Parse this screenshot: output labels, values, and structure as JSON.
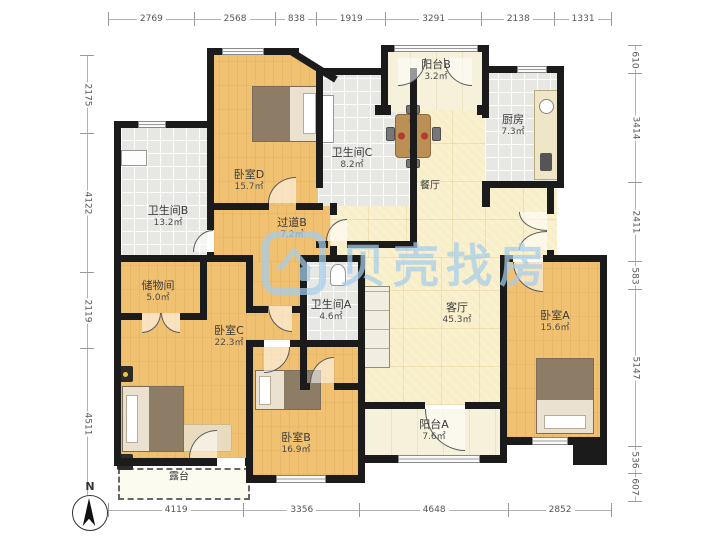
{
  "watermark": {
    "brand": "贝壳找房"
  },
  "compass": {
    "label": "N"
  },
  "dimensions": {
    "top": [
      "2769",
      "2568",
      "838",
      "1919",
      "3291",
      "2138",
      "1331"
    ],
    "bottom": [
      "4119",
      "3356",
      "4648",
      "2852"
    ],
    "left": [
      "2175",
      "4122",
      "2119",
      "4511"
    ],
    "right": [
      "610",
      "3414",
      "2411",
      "583",
      "5147",
      "536",
      "607"
    ]
  },
  "rooms": [
    {
      "id": "bedroom-d",
      "name": "卧室D",
      "area": "15.7㎡"
    },
    {
      "id": "bathroom-c",
      "name": "卫生间C",
      "area": "8.2㎡"
    },
    {
      "id": "balcony-b",
      "name": "阳台B",
      "area": "3.2㎡"
    },
    {
      "id": "kitchen",
      "name": "厨房",
      "area": "7.3㎡"
    },
    {
      "id": "dining",
      "name": "餐厅",
      "area": ""
    },
    {
      "id": "hallway-b",
      "name": "过道B",
      "area": "7.2㎡"
    },
    {
      "id": "bathroom-b",
      "name": "卫生间B",
      "area": "13.2㎡"
    },
    {
      "id": "storage",
      "name": "储物间",
      "area": "5.0㎡"
    },
    {
      "id": "bedroom-c",
      "name": "卧室C",
      "area": "22.3㎡"
    },
    {
      "id": "bathroom-a",
      "name": "卫生间A",
      "area": "4.6㎡"
    },
    {
      "id": "living",
      "name": "客厅",
      "area": "45.3㎡"
    },
    {
      "id": "bedroom-a",
      "name": "卧室A",
      "area": "15.6㎡"
    },
    {
      "id": "bedroom-b",
      "name": "卧室B",
      "area": "16.9㎡"
    },
    {
      "id": "balcony-a",
      "name": "阳台A",
      "area": "7.6㎡"
    },
    {
      "id": "terrace",
      "name": "露台",
      "area": ""
    }
  ]
}
